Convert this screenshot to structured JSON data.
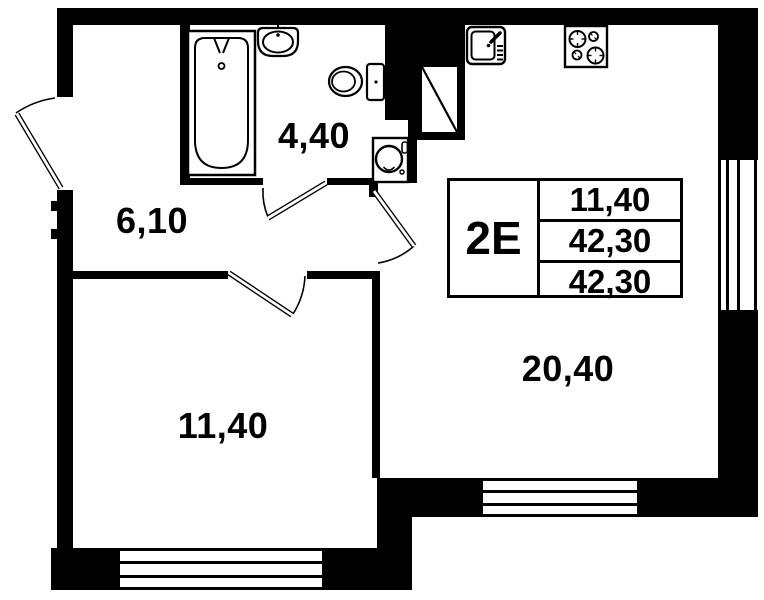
{
  "plan": {
    "unit_label": "2Е",
    "spec_table": {
      "rows": [
        "11,40",
        "42,30",
        "42,30"
      ]
    },
    "rooms": [
      {
        "id": "bathroom",
        "area": "4,40"
      },
      {
        "id": "hallway",
        "area": "6,10"
      },
      {
        "id": "bedroom",
        "area": "11,40"
      },
      {
        "id": "living-kitchen",
        "area": "20,40"
      }
    ],
    "fixtures": [
      "bathtub",
      "wash-basin",
      "toilet",
      "washing-machine",
      "ventilation-shaft",
      "kitchen-sink",
      "stove"
    ],
    "colors": {
      "ink": "#000000",
      "paper": "#ffffff"
    }
  }
}
